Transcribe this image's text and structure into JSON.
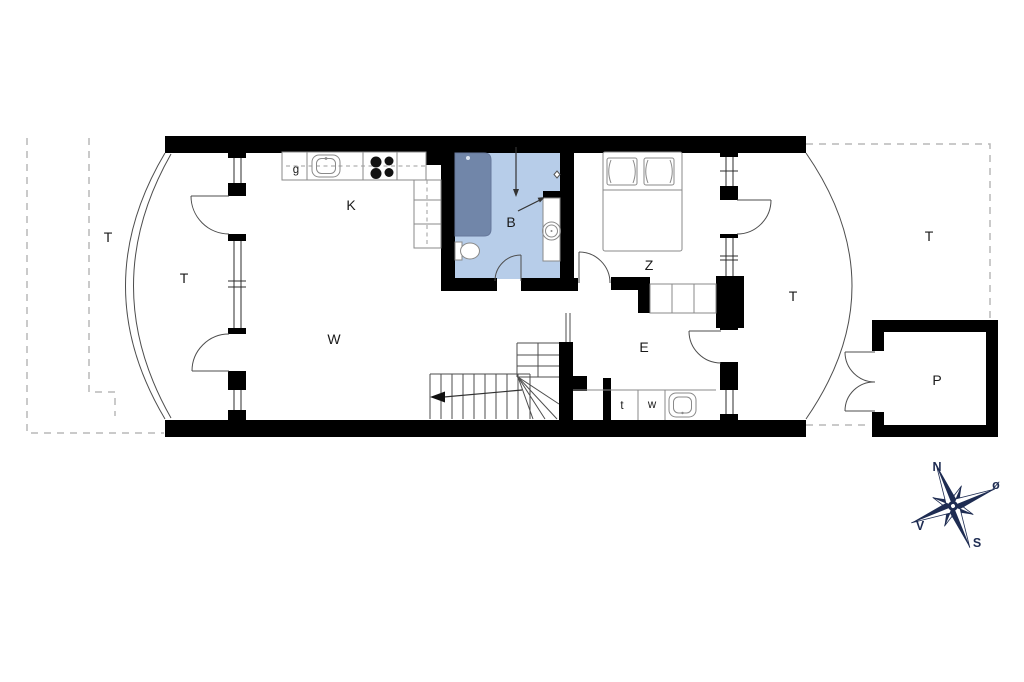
{
  "labels": {
    "terrace_far_left": "T",
    "terrace_left": "T",
    "kitchen": "K",
    "bathroom": "B",
    "living_room": "W",
    "bedroom": "Z",
    "entry_hall": "E",
    "terrace_right": "T",
    "terrace_far_right": "T",
    "outbuilding": "P",
    "appliance": "g",
    "toilet_room": "t",
    "washer": "w"
  },
  "compass": {
    "north": "N",
    "east": "ø",
    "south": "S",
    "west": "V"
  },
  "colors": {
    "wall": "#000000",
    "bath_floor": "#b7cde9",
    "shower": "#7186a9",
    "compass": "#1e2c52",
    "dashed": "#b8b8b8",
    "outline": "#4d4d4d",
    "fixture": "#8a8a8a",
    "text": "#1a1a1a"
  }
}
